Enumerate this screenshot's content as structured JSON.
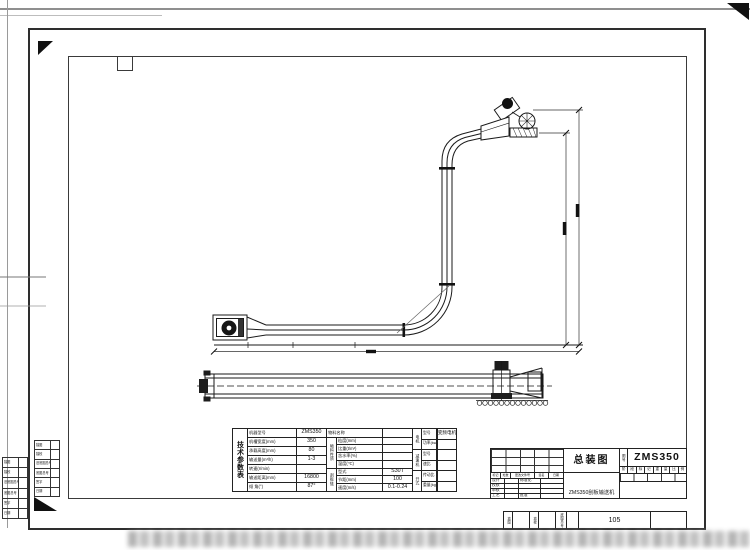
{
  "tech_table": {
    "title": "技术参数表",
    "left_rows": [
      {
        "label": "机器型号",
        "value": "ZMS350"
      },
      {
        "label": "机槽宽度(mm)",
        "value": "350"
      },
      {
        "label": "承载高度(mm)",
        "value": "80"
      },
      {
        "label": "输送量(m³/h)",
        "value": "1-3"
      },
      {
        "label": "转速(r/min)",
        "value": ""
      },
      {
        "label": "输送距离(mm)",
        "value": "16800"
      },
      {
        "label": "倾 角(°)",
        "value": "87°"
      }
    ],
    "material_header": {
      "label": "物料名称",
      "value": ""
    },
    "material_group": "物料性质",
    "material_rows": [
      {
        "label": "粒度(mm)",
        "value": ""
      },
      {
        "label": "比重(t/m³)",
        "value": ""
      },
      {
        "label": "含水率(%)",
        "value": ""
      },
      {
        "label": "温度(℃)",
        "value": ""
      }
    ],
    "chain_group": "刮板链",
    "chain_rows": [
      {
        "label": "型式",
        "value": "S30T"
      },
      {
        "label": "节距(mm)",
        "value": "100"
      },
      {
        "label": "速度(m/s)",
        "value": "0.1-0.24"
      }
    ],
    "drive_groups": [
      {
        "group": "电机",
        "rows": [
          {
            "label": "型号",
            "value": "变频电机"
          },
          {
            "label": "功率(kw)",
            "value": ""
          }
        ]
      },
      {
        "group": "减速机",
        "rows": [
          {
            "label": "型号",
            "value": ""
          },
          {
            "label": "速比",
            "value": ""
          }
        ]
      },
      {
        "group": "开式",
        "rows": [
          {
            "label": "传动比",
            "value": ""
          },
          {
            "label": "重量(kg)",
            "value": ""
          }
        ]
      }
    ]
  },
  "title_block": {
    "title": "总装图",
    "drawing_no_label": "图号",
    "drawing_no": "ZMS350",
    "product_name": "ZMS350刮板输送机",
    "stage_cells": [
      "阶",
      "段",
      "标",
      "记",
      "重",
      "量",
      "比",
      "例"
    ],
    "rev_header": [
      "标记",
      "处数",
      "更改文件号",
      "签名",
      "日期"
    ],
    "sig_labels": [
      "设计",
      "校核",
      "审核",
      "工艺"
    ],
    "sig_labels2": [
      "标准化",
      "",
      "",
      "批准"
    ]
  },
  "bottom_strip": {
    "cells": [
      "描图",
      "描校",
      "底图总号"
    ],
    "number": "105"
  },
  "margin_table": {
    "rows": [
      "描图",
      "描校",
      "旧底图总号",
      "底图总号",
      "签字",
      "日期"
    ]
  }
}
